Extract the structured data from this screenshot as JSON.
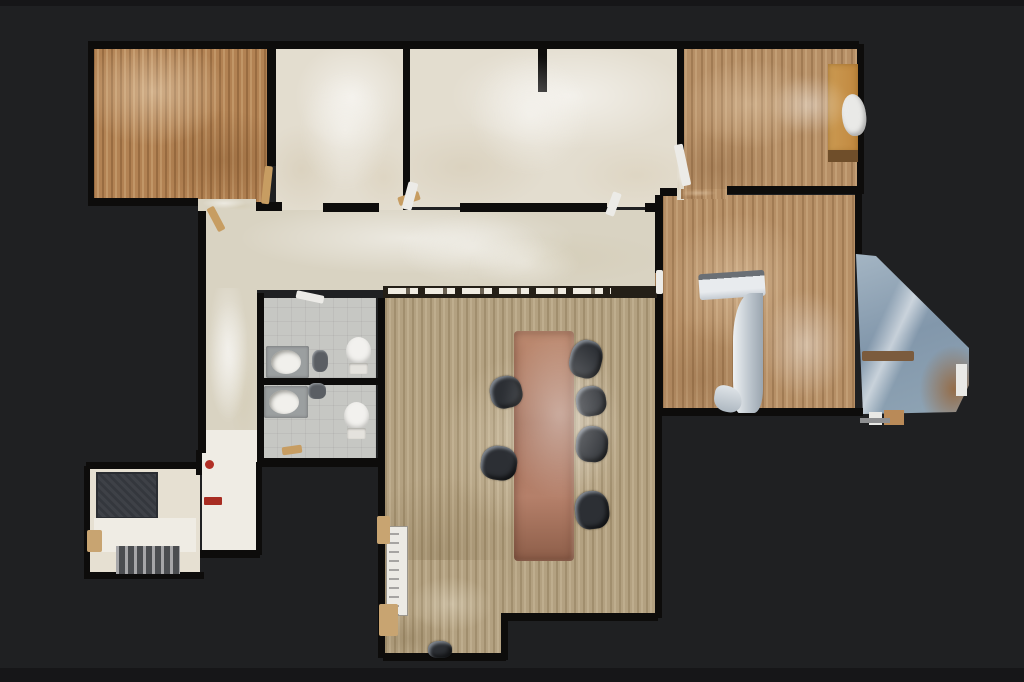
{
  "palette": {
    "bg": "#1f2022",
    "wall": "#0d0c0b",
    "wood_warm": "#b28253",
    "wood_mid": "#b68f66",
    "wood_gray": "#b3a181",
    "carpet": "#e3ddcf",
    "carpet_hall": "#d9d3c2",
    "tile": "#c6c7c3",
    "cream": "#e6e0d2",
    "white_floor": "#efece4",
    "table_copper": "#a5705a",
    "chair_dark": "#2c2f34",
    "glass_blue": "#8297ab",
    "desk_orange": "#cb9a52",
    "accent_red": "#b23026"
  },
  "floorplan": {
    "items": [
      {
        "kind": "room-wood-warm",
        "name": "room-office-nw",
        "x": 93,
        "y": 48,
        "w": 174,
        "h": 156,
        "interactable": true
      },
      {
        "kind": "room-carpet",
        "name": "room-office-n1",
        "x": 276,
        "y": 48,
        "w": 127,
        "h": 162,
        "interactable": true
      },
      {
        "kind": "room-carpet",
        "name": "room-office-n2",
        "x": 410,
        "y": 48,
        "w": 267,
        "h": 159,
        "interactable": true
      },
      {
        "kind": "room-wood-mid",
        "name": "room-office-ne",
        "x": 681,
        "y": 48,
        "w": 176,
        "h": 141,
        "interactable": true
      },
      {
        "kind": "room-wood-mid",
        "name": "room-east",
        "x": 662,
        "y": 195,
        "w": 193,
        "h": 216,
        "interactable": true
      },
      {
        "kind": "room-carpet-hall",
        "name": "hallway",
        "x": 205,
        "y": 210,
        "w": 450,
        "h": 80,
        "interactable": true
      },
      {
        "kind": "room-carpet-hall",
        "name": "corridor-upper",
        "x": 204,
        "y": 288,
        "w": 53,
        "h": 170,
        "interactable": true
      },
      {
        "kind": "room-white",
        "name": "corridor-lower",
        "x": 202,
        "y": 430,
        "w": 56,
        "h": 122,
        "interactable": true
      },
      {
        "kind": "room-tile",
        "name": "restroom-a",
        "x": 263,
        "y": 298,
        "w": 113,
        "h": 80,
        "interactable": true
      },
      {
        "kind": "room-tile",
        "name": "restroom-b",
        "x": 263,
        "y": 385,
        "w": 113,
        "h": 77,
        "interactable": true
      },
      {
        "kind": "room-wood-gray",
        "name": "conference-room",
        "x": 385,
        "y": 298,
        "w": 270,
        "h": 322,
        "interactable": true
      },
      {
        "kind": "room-wood-gray",
        "name": "conference-room-annex",
        "x": 385,
        "y": 560,
        "w": 120,
        "h": 98,
        "interactable": true
      },
      {
        "kind": "room-cream",
        "name": "entry-room",
        "x": 88,
        "y": 468,
        "w": 112,
        "h": 107,
        "interactable": true
      },
      {
        "kind": "glass",
        "name": "glass-wall-scan",
        "x": 856,
        "y": 248,
        "w": 114,
        "h": 168,
        "interactable": false,
        "clip": "polygon(0px 6px, 20px 8px, 113px 100px, 113px 137px, 100px 164px, 7px 166px)"
      },
      {
        "kind": "wall",
        "name": "wall",
        "x": 88,
        "y": 41,
        "w": 771,
        "h": 8
      },
      {
        "kind": "wall",
        "name": "wall",
        "x": 88,
        "y": 44,
        "w": 6,
        "h": 160
      },
      {
        "kind": "wall",
        "name": "wall",
        "x": 88,
        "y": 198,
        "w": 110,
        "h": 8
      },
      {
        "kind": "wall",
        "name": "wall",
        "x": 256,
        "y": 202,
        "w": 26,
        "h": 9
      },
      {
        "kind": "wall",
        "name": "wall",
        "x": 267,
        "y": 44,
        "w": 9,
        "h": 122
      },
      {
        "kind": "wall",
        "name": "wall",
        "x": 403,
        "y": 44,
        "w": 7,
        "h": 166
      },
      {
        "kind": "wall",
        "name": "wall",
        "x": 538,
        "y": 44,
        "w": 9,
        "h": 48
      },
      {
        "kind": "wall",
        "name": "wall",
        "x": 677,
        "y": 44,
        "w": 7,
        "h": 112
      },
      {
        "kind": "wall",
        "name": "wall",
        "x": 857,
        "y": 44,
        "w": 7,
        "h": 150
      },
      {
        "kind": "wall",
        "name": "wall",
        "x": 727,
        "y": 186,
        "w": 132,
        "h": 8
      },
      {
        "kind": "wall",
        "name": "wall",
        "x": 660,
        "y": 188,
        "w": 22,
        "h": 8
      },
      {
        "kind": "wall",
        "name": "wall",
        "x": 655,
        "y": 195,
        "w": 8,
        "h": 78
      },
      {
        "kind": "wall",
        "name": "wall",
        "x": 655,
        "y": 292,
        "w": 8,
        "h": 122
      },
      {
        "kind": "wall",
        "name": "wall",
        "x": 855,
        "y": 192,
        "w": 7,
        "h": 62
      },
      {
        "kind": "wall",
        "name": "wall",
        "x": 655,
        "y": 408,
        "w": 208,
        "h": 8
      },
      {
        "kind": "wall",
        "name": "wall",
        "x": 198,
        "y": 207,
        "w": 8,
        "h": 246
      },
      {
        "kind": "wall",
        "name": "wall",
        "x": 323,
        "y": 203,
        "w": 56,
        "h": 9
      },
      {
        "kind": "wall",
        "name": "wall",
        "x": 460,
        "y": 203,
        "w": 147,
        "h": 9
      },
      {
        "kind": "wall",
        "name": "wall",
        "x": 645,
        "y": 203,
        "w": 12,
        "h": 9
      },
      {
        "kind": "wall",
        "name": "wall",
        "x": 378,
        "y": 298,
        "w": 7,
        "h": 360
      },
      {
        "kind": "wall",
        "name": "wall",
        "x": 655,
        "y": 411,
        "w": 7,
        "h": 207
      },
      {
        "kind": "wall",
        "name": "wall",
        "x": 505,
        "y": 613,
        "w": 153,
        "h": 8
      },
      {
        "kind": "wall",
        "name": "wall",
        "x": 501,
        "y": 613,
        "w": 7,
        "h": 47
      },
      {
        "kind": "wall",
        "name": "wall",
        "x": 383,
        "y": 653,
        "w": 123,
        "h": 8
      },
      {
        "kind": "wall",
        "name": "wall",
        "x": 257,
        "y": 293,
        "w": 7,
        "h": 172
      },
      {
        "kind": "wall",
        "name": "wall",
        "x": 258,
        "y": 378,
        "w": 120,
        "h": 7
      },
      {
        "kind": "wall",
        "name": "wall",
        "x": 257,
        "y": 458,
        "w": 124,
        "h": 9
      },
      {
        "kind": "wall",
        "name": "wall",
        "x": 256,
        "y": 462,
        "w": 6,
        "h": 93
      },
      {
        "kind": "wall",
        "name": "wall",
        "x": 200,
        "y": 550,
        "w": 60,
        "h": 8
      },
      {
        "kind": "wall",
        "name": "wall",
        "x": 86,
        "y": 462,
        "w": 116,
        "h": 7
      },
      {
        "kind": "wall",
        "name": "wall",
        "x": 84,
        "y": 466,
        "w": 6,
        "h": 112
      },
      {
        "kind": "wall",
        "name": "wall",
        "x": 84,
        "y": 572,
        "w": 120,
        "h": 7
      },
      {
        "kind": "wall",
        "name": "wall",
        "x": 196,
        "y": 450,
        "w": 6,
        "h": 25
      },
      {
        "kind": "room-carpet-hall",
        "name": "floor-patch",
        "x": 198,
        "y": 199,
        "w": 58,
        "h": 12
      },
      {
        "kind": "room-carpet",
        "name": "floor-patch",
        "x": 677,
        "y": 156,
        "w": 7,
        "h": 44
      },
      {
        "kind": "room-wood-mid",
        "name": "floor-patch",
        "x": 681,
        "y": 189,
        "w": 46,
        "h": 10
      },
      {
        "kind": "room-wood-mid",
        "name": "floor-patch",
        "x": 655,
        "y": 273,
        "w": 8,
        "h": 20
      },
      {
        "kind": "counter",
        "name": "reception-counter",
        "x": 383,
        "y": 286,
        "w": 274,
        "h": 12
      },
      {
        "kind": "door-tan",
        "name": "door-leaf",
        "x": 263,
        "y": 166,
        "w": 8,
        "h": 38,
        "rot": 6
      },
      {
        "kind": "door-tan",
        "name": "door-leaf",
        "x": 398,
        "y": 194,
        "w": 22,
        "h": 9,
        "rot": -18
      },
      {
        "kind": "door-white",
        "name": "door-leaf",
        "x": 609,
        "y": 192,
        "w": 9,
        "h": 24,
        "rot": 20
      },
      {
        "kind": "door-white",
        "name": "door-leaf",
        "x": 678,
        "y": 144,
        "w": 9,
        "h": 42,
        "rot": -12
      },
      {
        "kind": "door-white",
        "name": "door-leaf",
        "x": 656,
        "y": 270,
        "w": 7,
        "h": 24
      },
      {
        "kind": "door-white",
        "name": "door-leaf",
        "x": 296,
        "y": 293,
        "w": 28,
        "h": 8,
        "rot": 12
      },
      {
        "kind": "door-tan",
        "name": "door-leaf",
        "x": 282,
        "y": 446,
        "w": 20,
        "h": 8,
        "rot": -8
      },
      {
        "kind": "door-tan",
        "name": "door-leaf",
        "x": 212,
        "y": 206,
        "w": 8,
        "h": 26,
        "rot": -28
      },
      {
        "kind": "door-white",
        "name": "door-leaf",
        "x": 405,
        "y": 182,
        "w": 10,
        "h": 28,
        "rot": 15
      },
      {
        "kind": "desk",
        "name": "desk",
        "x": 828,
        "y": 64,
        "w": 30,
        "h": 88
      },
      {
        "kind": "desk-edge",
        "name": "desk-edge",
        "x": 828,
        "y": 150,
        "w": 30,
        "h": 12
      },
      {
        "kind": "chair-white",
        "name": "task-chair",
        "x": 842,
        "y": 94,
        "w": 24,
        "h": 42,
        "rot": -6
      },
      {
        "kind": "table",
        "name": "conference-table",
        "x": 514,
        "y": 331,
        "w": 60,
        "h": 230
      },
      {
        "kind": "chair",
        "name": "office-chair",
        "x": 490,
        "y": 376,
        "w": 32,
        "h": 32,
        "rot": -12
      },
      {
        "kind": "chair",
        "name": "office-chair",
        "x": 481,
        "y": 446,
        "w": 36,
        "h": 34,
        "rot": 8
      },
      {
        "kind": "chair",
        "name": "office-chair",
        "x": 570,
        "y": 340,
        "w": 32,
        "h": 38,
        "rot": 14
      },
      {
        "kind": "chair",
        "name": "office-chair",
        "x": 576,
        "y": 386,
        "w": 30,
        "h": 30,
        "rot": -8
      },
      {
        "kind": "chair",
        "name": "office-chair",
        "x": 576,
        "y": 426,
        "w": 32,
        "h": 36,
        "rot": 4
      },
      {
        "kind": "chair",
        "name": "office-chair",
        "x": 575,
        "y": 491,
        "w": 34,
        "h": 38,
        "rot": -6
      },
      {
        "kind": "chair-small",
        "name": "office-chair",
        "x": 428,
        "y": 641,
        "w": 24,
        "h": 17
      },
      {
        "kind": "toilet-bowl",
        "name": "toilet",
        "x": 346,
        "y": 337,
        "w": 25,
        "h": 28
      },
      {
        "kind": "toilet-tank",
        "name": "toilet-tank",
        "x": 349,
        "y": 363,
        "w": 19,
        "h": 11
      },
      {
        "kind": "toilet-bowl",
        "name": "toilet",
        "x": 344,
        "y": 402,
        "w": 25,
        "h": 28
      },
      {
        "kind": "toilet-tank",
        "name": "toilet-tank",
        "x": 347,
        "y": 428,
        "w": 19,
        "h": 11
      },
      {
        "kind": "sink-counter",
        "name": "vanity",
        "x": 266,
        "y": 346,
        "w": 43,
        "h": 32
      },
      {
        "kind": "sink",
        "name": "sink",
        "x": 271,
        "y": 350,
        "w": 30,
        "h": 24
      },
      {
        "kind": "sink-counter",
        "name": "vanity",
        "x": 264,
        "y": 386,
        "w": 44,
        "h": 32
      },
      {
        "kind": "sink",
        "name": "sink",
        "x": 269,
        "y": 390,
        "w": 30,
        "h": 24
      },
      {
        "kind": "fixture",
        "name": "bath-fixture",
        "x": 312,
        "y": 350,
        "w": 16,
        "h": 22
      },
      {
        "kind": "fixture",
        "name": "bath-fixture",
        "x": 308,
        "y": 383,
        "w": 18,
        "h": 16
      },
      {
        "kind": "mat",
        "name": "entry-mat",
        "x": 96,
        "y": 472,
        "w": 62,
        "h": 47
      },
      {
        "kind": "room-white",
        "name": "entry-floor-band",
        "x": 94,
        "y": 518,
        "w": 102,
        "h": 34
      },
      {
        "kind": "dark-cluster",
        "name": "entry-steps",
        "x": 116,
        "y": 546,
        "w": 64,
        "h": 28
      },
      {
        "kind": "tan-square",
        "name": "cabinet",
        "x": 87,
        "y": 530,
        "w": 15,
        "h": 22
      },
      {
        "kind": "red-dot",
        "name": "fire-extinguisher",
        "x": 205,
        "y": 460,
        "w": 9,
        "h": 9
      },
      {
        "kind": "red-bar",
        "name": "red-equipment",
        "x": 204,
        "y": 497,
        "w": 18,
        "h": 8
      },
      {
        "kind": "whiteboard",
        "name": "whiteboard",
        "x": 386,
        "y": 526,
        "w": 22,
        "h": 90
      },
      {
        "kind": "tan-blob",
        "name": "cabinet",
        "x": 377,
        "y": 516,
        "w": 13,
        "h": 28
      },
      {
        "kind": "tan-blob",
        "name": "cabinet",
        "x": 379,
        "y": 604,
        "w": 19,
        "h": 32
      },
      {
        "kind": "glass-bar",
        "name": "window-sill-scan",
        "x": 862,
        "y": 351,
        "w": 52,
        "h": 10
      },
      {
        "kind": "fragment-white",
        "name": "scan-fragment",
        "x": 956,
        "y": 364,
        "w": 11,
        "h": 32
      },
      {
        "kind": "fragment-white",
        "name": "scan-fragment",
        "x": 869,
        "y": 412,
        "w": 13,
        "h": 13
      },
      {
        "kind": "fragment-tan",
        "name": "scan-fragment",
        "x": 884,
        "y": 410,
        "w": 20,
        "h": 15
      },
      {
        "kind": "gray-line",
        "name": "scan-fragment",
        "x": 860,
        "y": 418,
        "w": 30,
        "h": 5
      },
      {
        "kind": "artifact-a",
        "name": "scan-artifact",
        "x": 699,
        "y": 272,
        "w": 66,
        "h": 26,
        "rot": -4
      },
      {
        "kind": "artifact-b",
        "name": "scan-artifact",
        "x": 733,
        "y": 293,
        "w": 30,
        "h": 120
      },
      {
        "kind": "artifact-c",
        "name": "scan-artifact",
        "x": 714,
        "y": 386,
        "w": 28,
        "h": 26,
        "rot": 10
      },
      {
        "kind": "light",
        "name": "light-bloom",
        "x": 398,
        "y": 214,
        "w": 150,
        "h": 70
      },
      {
        "kind": "light",
        "name": "light-bloom",
        "x": 470,
        "y": 238,
        "w": 110,
        "h": 50
      },
      {
        "kind": "light",
        "name": "light-bloom",
        "x": 470,
        "y": 55,
        "w": 120,
        "h": 120
      },
      {
        "kind": "light",
        "name": "light-bloom",
        "x": 300,
        "y": 70,
        "w": 90,
        "h": 120
      },
      {
        "kind": "light",
        "name": "light-bloom",
        "x": 500,
        "y": 330,
        "w": 120,
        "h": 170
      },
      {
        "kind": "light",
        "name": "light-bloom",
        "x": 760,
        "y": 290,
        "w": 90,
        "h": 110
      },
      {
        "kind": "light",
        "name": "light-bloom",
        "x": 770,
        "y": 75,
        "w": 80,
        "h": 60
      },
      {
        "kind": "light",
        "name": "light-bloom",
        "x": 208,
        "y": 300,
        "w": 44,
        "h": 120
      }
    ]
  }
}
